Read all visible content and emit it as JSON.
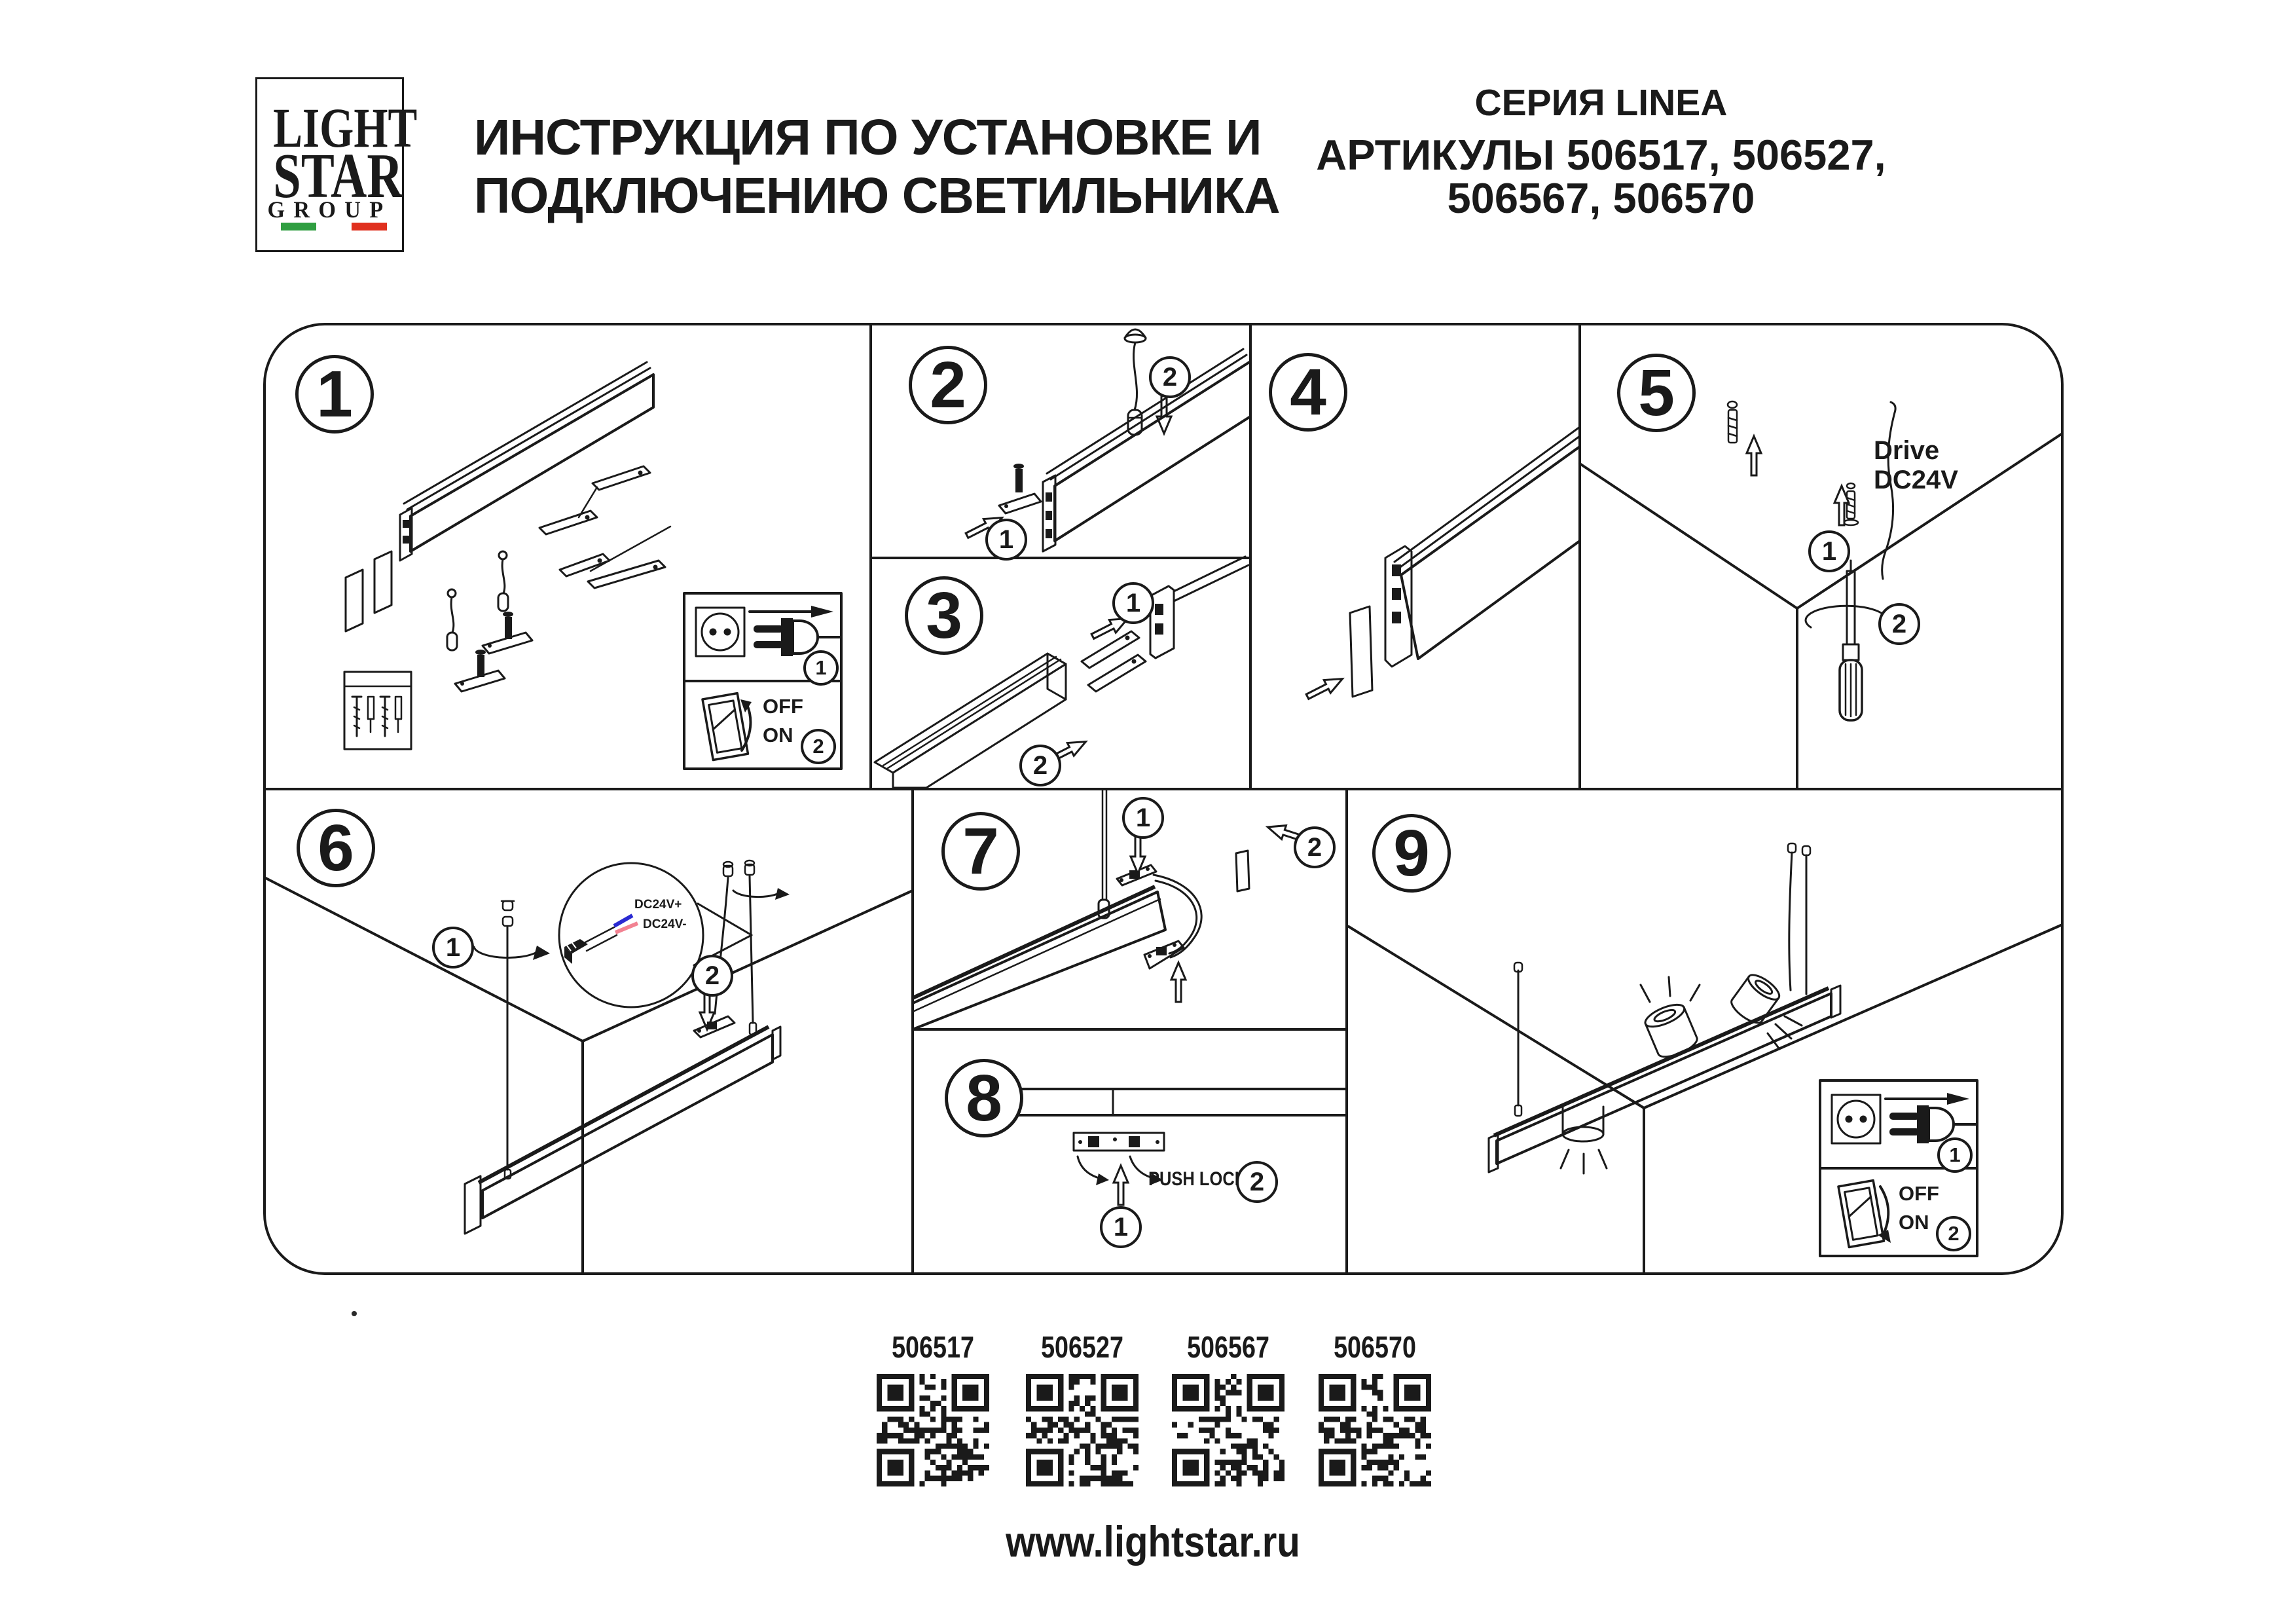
{
  "logo": {
    "word1": "LIGHT",
    "word2": "STAR",
    "word3": "GROUP",
    "flag_green": "#2f9e41",
    "flag_white": "#ffffff",
    "flag_red": "#e0301e"
  },
  "header": {
    "title_line1": "ИНСТРУКЦИЯ ПО УСТАНОВКЕ И",
    "title_line2": "ПОДКЛЮЧЕНИЮ СВЕТИЛЬНИКА",
    "series": "СЕРИЯ LINEA",
    "articles_line1": "АРТИКУЛЫ 506517, 506527,",
    "articles_line2": "506567, 506570"
  },
  "steps": [
    "1",
    "2",
    "3",
    "4",
    "5",
    "6",
    "7",
    "8",
    "9"
  ],
  "ann": {
    "one": "1",
    "two": "2"
  },
  "labels": {
    "off": "OFF",
    "on": "ON",
    "push_lock": "PUSH LOCK",
    "drive_line1": "Drive",
    "drive_line2": "DC24V",
    "wire_plus": "DC24V+",
    "wire_minus": "DC24V-"
  },
  "wires": {
    "plus_color": "#2a2ad2",
    "minus_color": "#f28292"
  },
  "qr": {
    "items": [
      {
        "article": "506517"
      },
      {
        "article": "506527"
      },
      {
        "article": "506567"
      },
      {
        "article": "506570"
      }
    ]
  },
  "footer": {
    "url": "www.lightstar.ru"
  }
}
